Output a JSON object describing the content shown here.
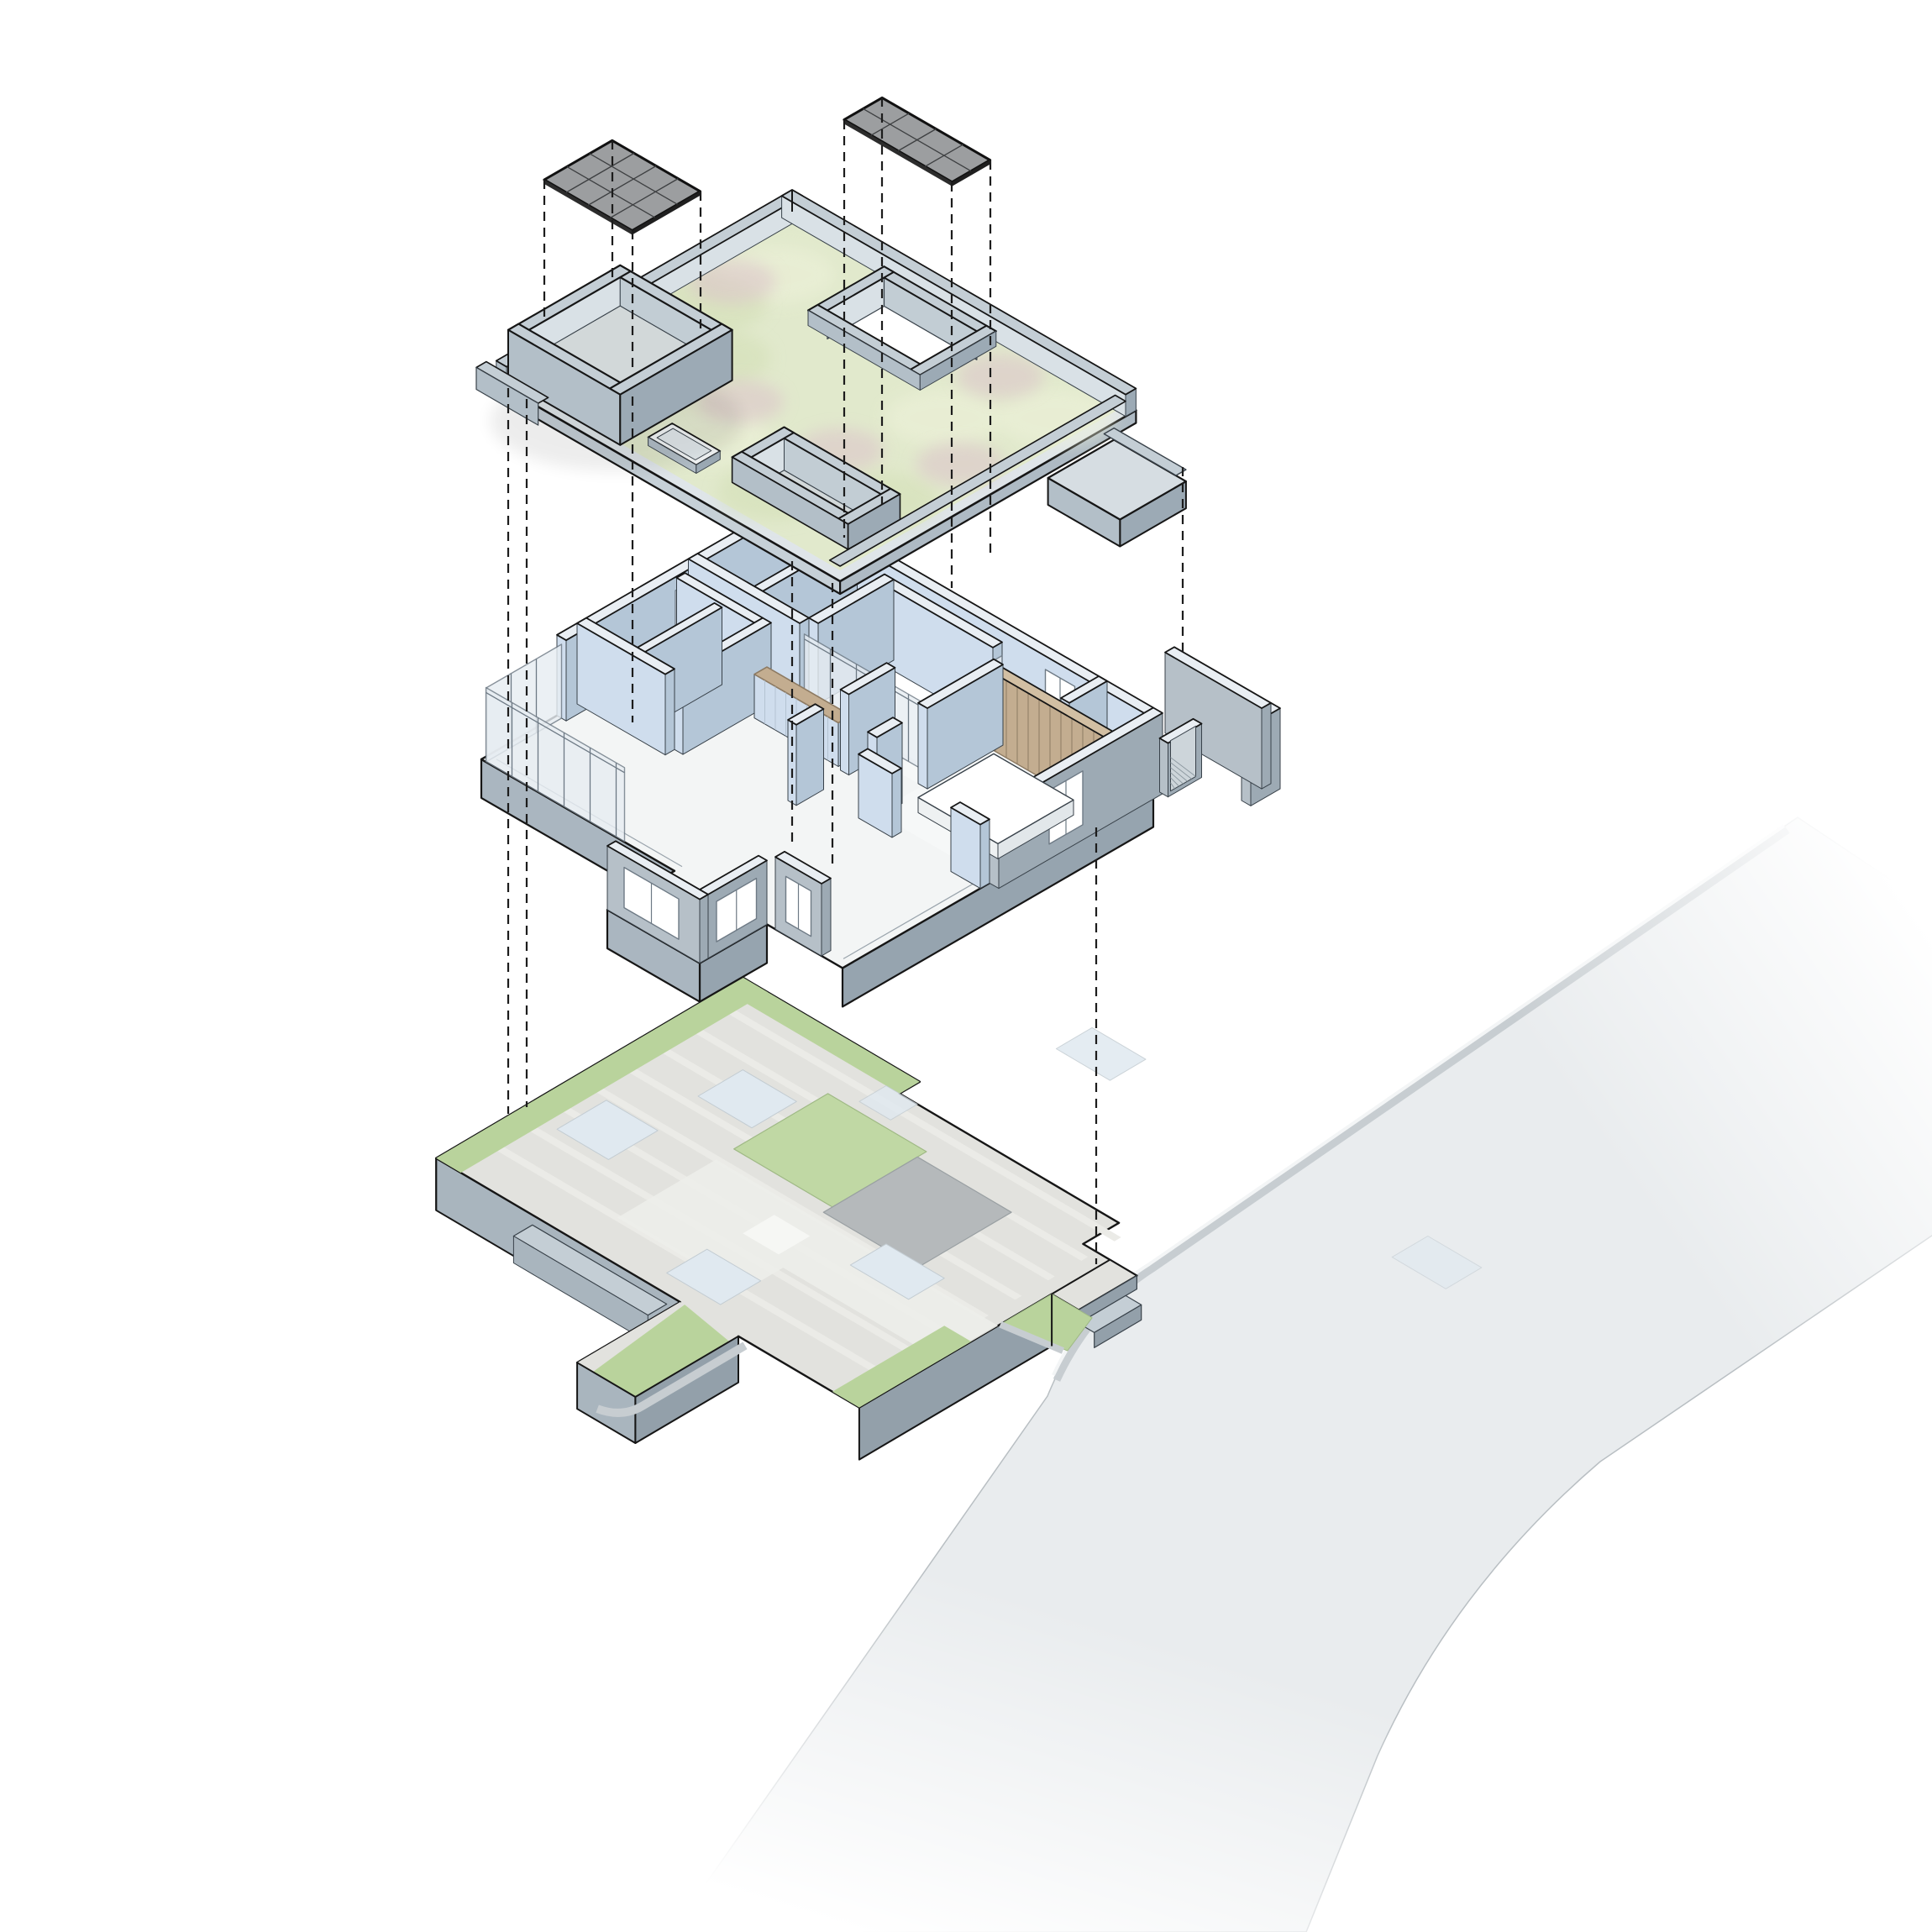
{
  "title_meta": "exploded-axonometric-building-diagram",
  "visible_text": [],
  "projection": {
    "type": "isometric-exploded",
    "dash_pattern": "11 8",
    "dash_color": "#1c1c1c"
  },
  "solar_panels": {
    "left": {
      "name": "pv-array-over-roof-terrace",
      "cols": 4,
      "rows": 3
    },
    "right": {
      "name": "pv-array-over-courtyard",
      "cols": 4,
      "rows": 2
    }
  },
  "layers": [
    {
      "name": "solar-panels",
      "elements": [
        "pv-array-left",
        "pv-array-right"
      ]
    },
    {
      "name": "green-roof",
      "elements": [
        "sedum-field",
        "flower-patches",
        "parapet",
        "roof-terrace-tray",
        "skylight",
        "courtyard-opening",
        "sunken-tray",
        "entry-walkway-strip"
      ]
    },
    {
      "name": "floor-plan",
      "elements": [
        "perimeter-walls",
        "glazed-facade",
        "courtyard-glazing",
        "bathroom-block",
        "kitchen-counter",
        "bedroom-wing",
        "timber-panel-wall",
        "bed",
        "porch-room",
        "terrace-window-wall",
        "garden-l-wall",
        "entry-gate"
      ]
    },
    {
      "name": "site-plan",
      "elements": [
        "plinth",
        "lawn-square",
        "patio-square",
        "paving-marks",
        "planting-strips",
        "retaining-walls",
        "entry-steps",
        "porch-plinth"
      ]
    },
    {
      "name": "road",
      "elements": [
        "carriageway",
        "kerb",
        "crossing-marks"
      ]
    }
  ],
  "colors": {
    "bg": "#ffffff",
    "outline": "#161616",
    "thinline": "#39424a",
    "dash": "#1c1c1c",
    "panelFill": "#9c9ea0",
    "panelGrid": "#3d3f41",
    "roofGreen": "#e1e9cc",
    "roofGreenLight": "#eef2da",
    "roofGreenDark": "#d3dfb6",
    "pink": "#dcc3ca",
    "parapetTop": "#c4ced5",
    "parapetL": "#b3bfc8",
    "parapetR": "#9caab5",
    "parapetInner": "#d9e1e6",
    "trayFloor": "#d2d8d9",
    "roofEdgeL": "#c6d0d7",
    "roofEdgeR": "#aebac4",
    "stripTop": "#d6dde2",
    "slabTop": "#f3f5f5",
    "slabEdgeL": "#aab6c0",
    "slabEdgeR": "#96a4af",
    "roomFloor": "#f6f8f8",
    "bathFloor": "#eef1f3",
    "wallTop": "#e9eef3",
    "wallL": "#cfdded",
    "wallR": "#b4c6d7",
    "concreteL": "#b6c0c8",
    "concreteR": "#9daab4",
    "glass": "#e7edf2",
    "frame": "#6e7a85",
    "wood": "#c3ad90",
    "woodLine": "#8d7a62",
    "woodTop": "#d2bfa3",
    "siteTop": "#e2e2de",
    "siteStripe": "#ebebe7",
    "lawn": "#c0d8a4",
    "plantStrip": "#b9d39c",
    "patio": "#b5b9bb",
    "siteBlue": "#e0e9f0",
    "sitePath": "#edeeea",
    "siteWallL": "#a9b5be",
    "siteWallR": "#93a0aa",
    "kerb": "#c7cdd1",
    "kerbHi": "#f3f5f6",
    "road": "#e9ecee",
    "white": "#ffffff"
  }
}
